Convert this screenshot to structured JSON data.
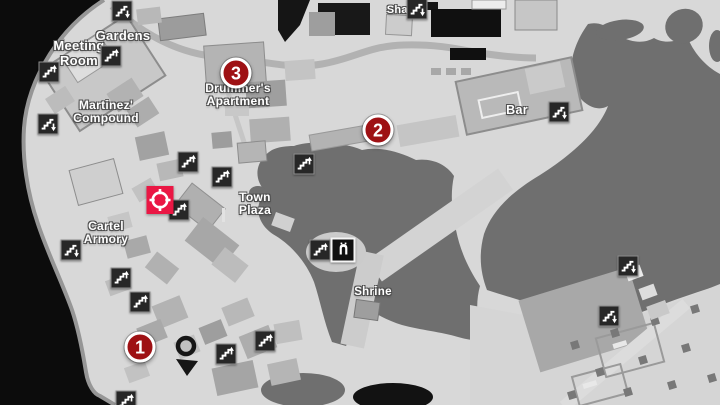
{
  "app": {
    "name": "town-map-view"
  },
  "colors": {
    "background": "#d8d8d8",
    "unexplored_void": "#0c0c0c",
    "terrain_dark": "#6f6f6f",
    "marker_red": "#9e1114",
    "objective_red": "#ea1744",
    "icon_background": "#272727",
    "label_text": "#ffffff"
  },
  "map": {
    "labels": [
      {
        "id": "gardens",
        "text": "Gardens",
        "x": 123,
        "y": 29,
        "size": 13
      },
      {
        "id": "meeting-room",
        "text": "Meeting\nRoom",
        "x": 79,
        "y": 39,
        "size": 13
      },
      {
        "id": "martinez-compound",
        "text": "Martinez'\nCompound",
        "x": 106,
        "y": 99,
        "size": 12
      },
      {
        "id": "drummers-apartment",
        "text": "Drummer's\nApartment",
        "x": 238,
        "y": 82,
        "size": 12
      },
      {
        "id": "shanty",
        "text": "Shanty",
        "x": 406,
        "y": 4,
        "size": 11
      },
      {
        "id": "bar",
        "text": "Bar",
        "x": 517,
        "y": 103,
        "size": 12.5
      },
      {
        "id": "town-plaza",
        "text": "Town\nPlaza",
        "x": 255,
        "y": 191,
        "size": 12
      },
      {
        "id": "cartel-armory",
        "text": "Cartel\nArmory",
        "x": 106,
        "y": 220,
        "size": 12
      },
      {
        "id": "shrine",
        "text": "Shrine",
        "x": 373,
        "y": 286,
        "size": 11.5
      }
    ],
    "markers": [
      {
        "number": "1",
        "x": 140,
        "y": 347
      },
      {
        "number": "2",
        "x": 378,
        "y": 130
      },
      {
        "number": "3",
        "x": 236,
        "y": 73
      }
    ],
    "player_marker": {
      "x": 186,
      "y": 346
    },
    "objective_marker": {
      "x": 160,
      "y": 200
    },
    "shrine_icon": {
      "x": 343,
      "y": 250
    },
    "stairs_icons": [
      {
        "x": 122,
        "y": 11,
        "dir": "down"
      },
      {
        "x": 417,
        "y": 9,
        "dir": "down"
      },
      {
        "x": 49,
        "y": 72,
        "dir": "up"
      },
      {
        "x": 111,
        "y": 56,
        "dir": "up"
      },
      {
        "x": 48,
        "y": 124,
        "dir": "down"
      },
      {
        "x": 188,
        "y": 162,
        "dir": "up"
      },
      {
        "x": 222,
        "y": 177,
        "dir": "up"
      },
      {
        "x": 179,
        "y": 210,
        "dir": "up"
      },
      {
        "x": 71,
        "y": 250,
        "dir": "down"
      },
      {
        "x": 121,
        "y": 278,
        "dir": "up"
      },
      {
        "x": 140,
        "y": 302,
        "dir": "up"
      },
      {
        "x": 304,
        "y": 164,
        "dir": "up"
      },
      {
        "x": 320,
        "y": 250,
        "dir": "up"
      },
      {
        "x": 226,
        "y": 354,
        "dir": "up"
      },
      {
        "x": 265,
        "y": 341,
        "dir": "up"
      },
      {
        "x": 126,
        "y": 401,
        "dir": "up"
      },
      {
        "x": 559,
        "y": 112,
        "dir": "down"
      },
      {
        "x": 628,
        "y": 266,
        "dir": "down"
      },
      {
        "x": 609,
        "y": 316,
        "dir": "down"
      }
    ]
  }
}
